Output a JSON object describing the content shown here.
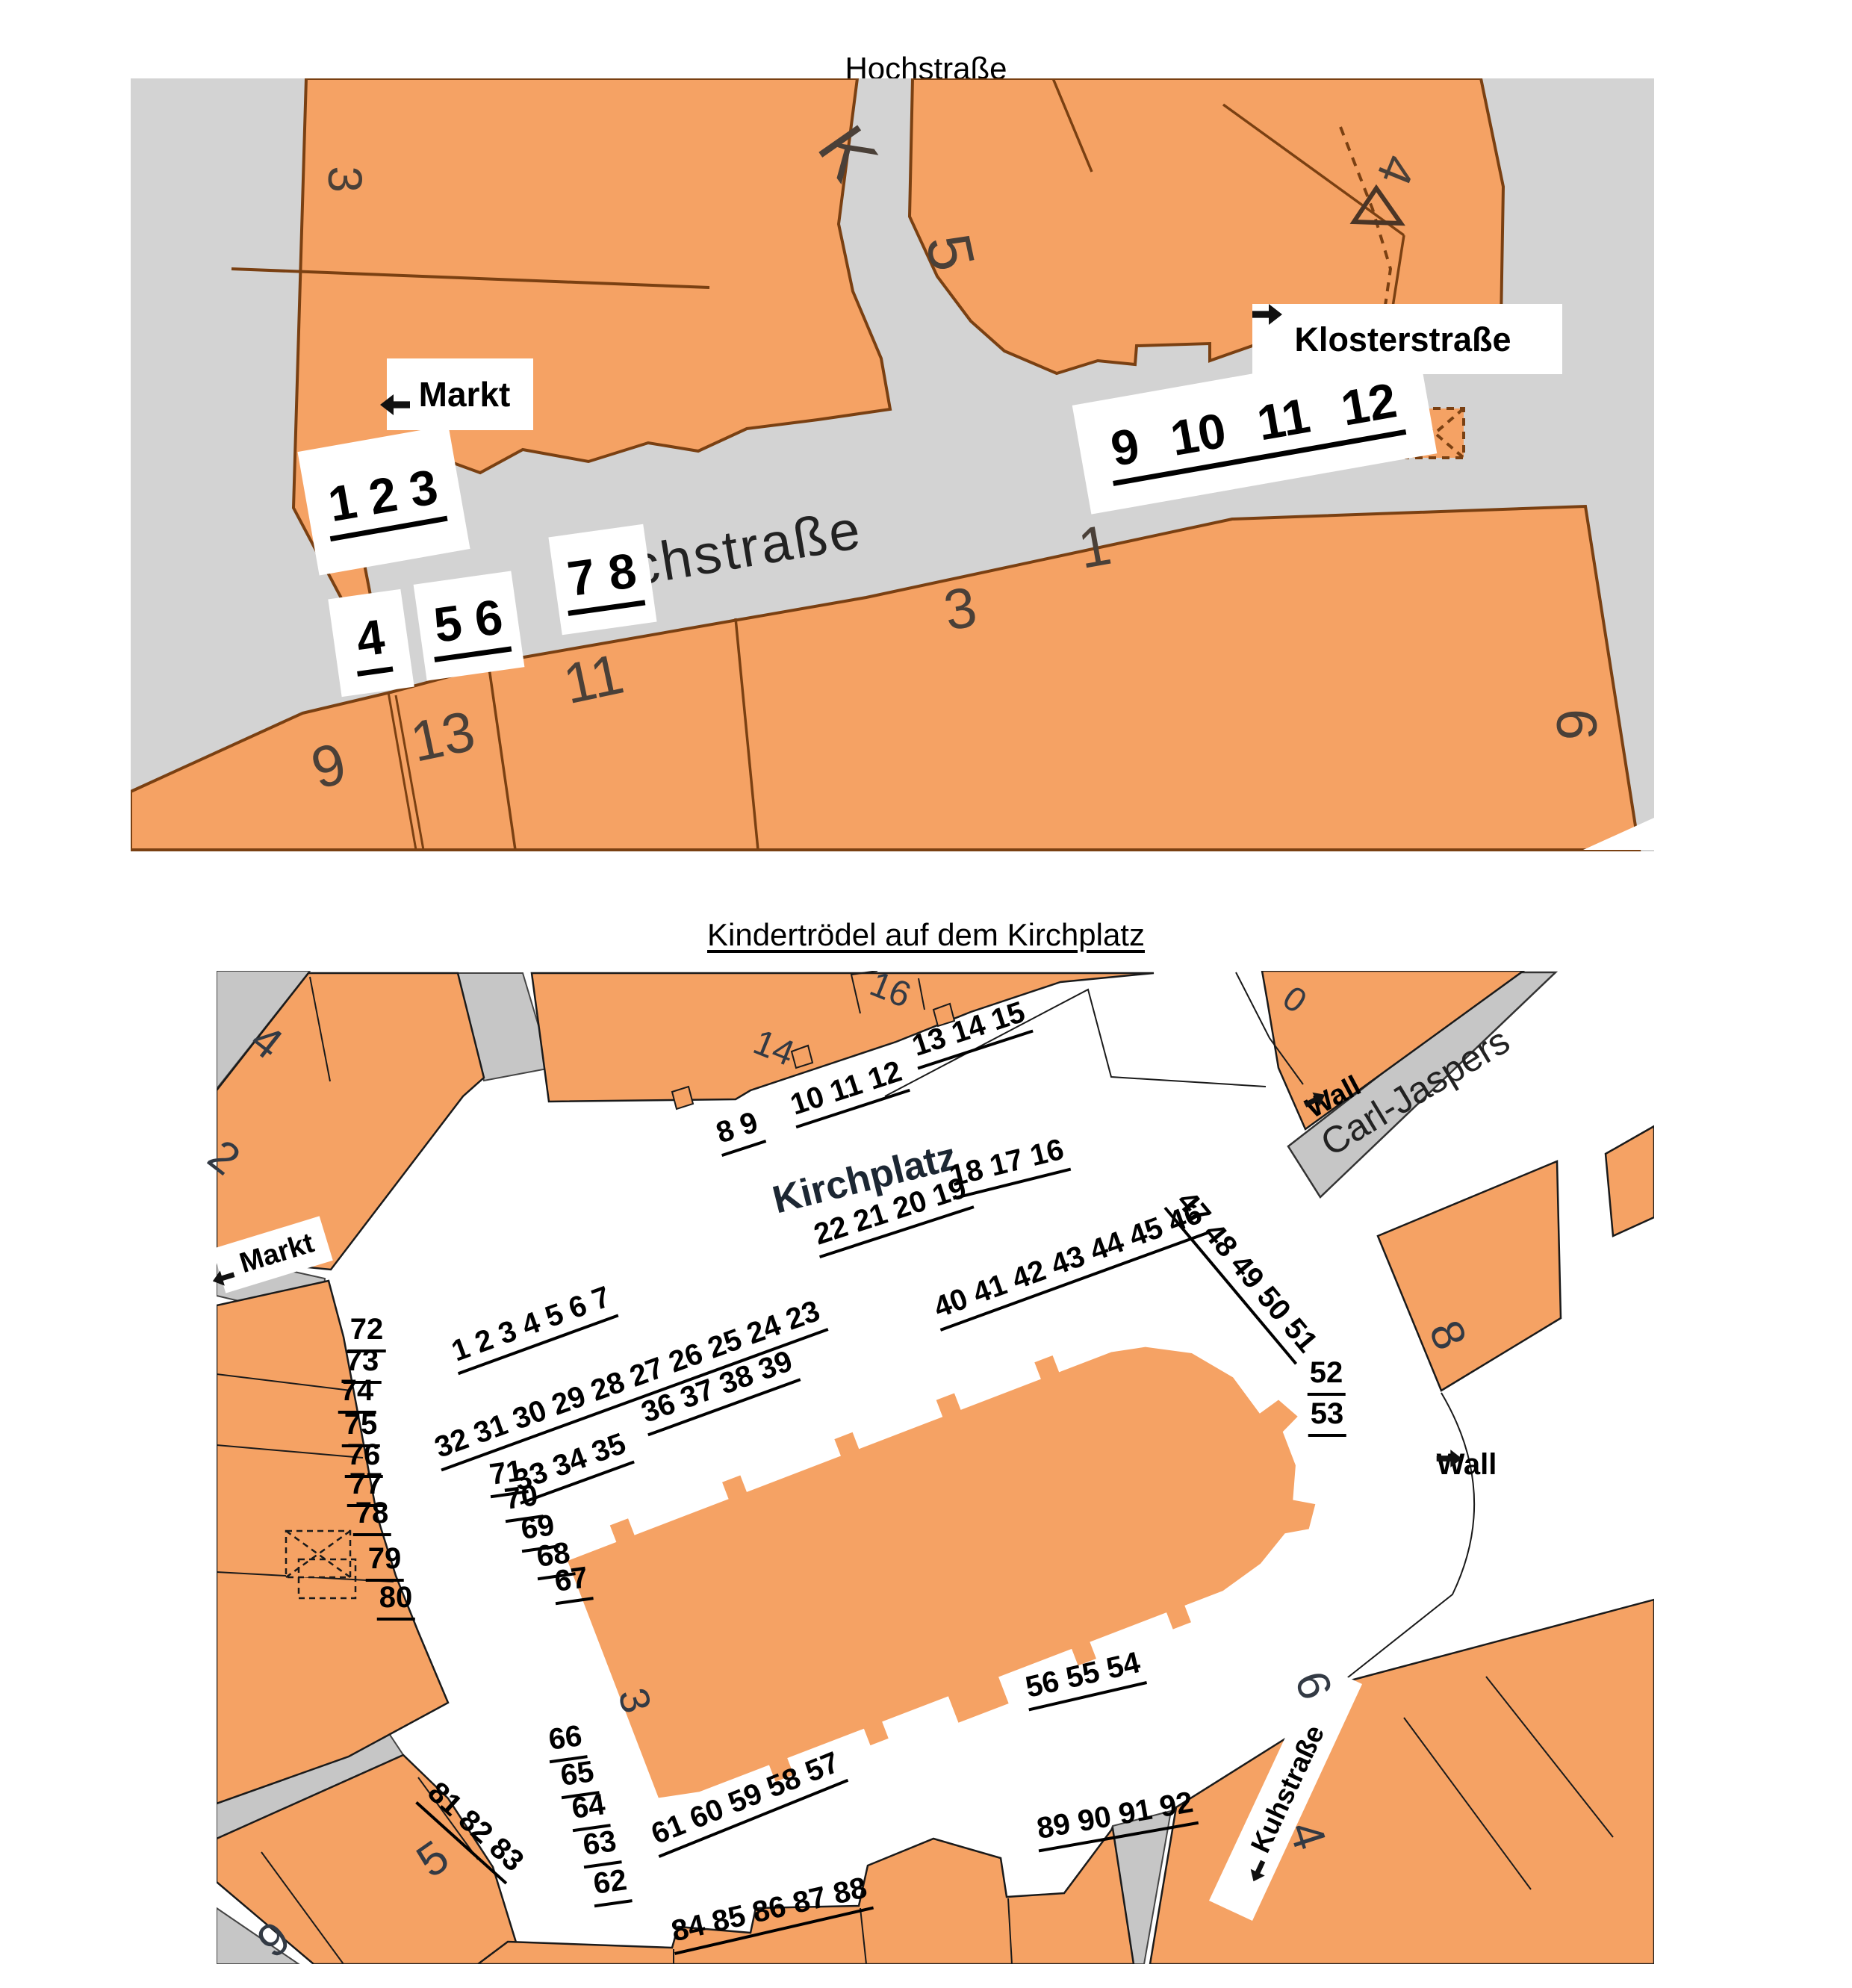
{
  "doc": {
    "title_top": "Hochstraße",
    "title_bottom": "Kindertrödel auf dem Kirchplatz"
  },
  "hochstrasse": {
    "street_label": "Hochstraße",
    "signs": {
      "markt": "Markt",
      "klosterstrasse": "Klosterstraße"
    },
    "stall_groups": {
      "g123": "1 2 3",
      "g4": "4",
      "g56": "5 6",
      "g78": "7 8",
      "g9_12": "9 10 11 12"
    },
    "parcels": {
      "nw3": "3",
      "nw7": "7",
      "k": "K",
      "n5": "5",
      "ne4": "4",
      "s9": "9",
      "s13": "13",
      "s11": "11",
      "s3": "3",
      "s1": "1",
      "e6": "6"
    }
  },
  "kirchplatz": {
    "square_label": "Kirchplatz",
    "streets": {
      "carl_jaspers": "Carl-Jaspers",
      "kuhstrasse": "Kuhstraße"
    },
    "signs": {
      "markt": "Markt",
      "wall_upper": "Wall",
      "wall_right": "Wall"
    },
    "stall_groups": {
      "g8_9": "8 9",
      "g10_12": "10 11 12",
      "g13_15": "13 14 15",
      "g22_19": "22 21 20 19",
      "g18_16": "18 17 16",
      "g1_7": "1 2 3 4 5 6 7",
      "g32_23": "32 31 30 29 28 27 26 25 24 23",
      "g33_35": "33 34 35",
      "g36_39": "36 37 38 39",
      "g40_46": "40 41 42 43 44 45 46",
      "g47_51": "47 48 49 50 51",
      "g52": "52",
      "g53": "53",
      "g61_57": "61 60 59 58 57",
      "g56_54": "56 55 54",
      "g84_88": "84 85 86 87 88",
      "g89_92": "89 90 91 92",
      "g81_83": "81 82 83"
    },
    "west_column": [
      "72",
      "73",
      "74",
      "75",
      "76",
      "77",
      "78",
      "79",
      "80"
    ],
    "church_column_upper": [
      "71",
      "70",
      "69",
      "68",
      "67"
    ],
    "church_column_lower": [
      "66",
      "65",
      "64",
      "63",
      "62"
    ],
    "parcels": {
      "nw4": "4",
      "w2": "2",
      "n14": "14",
      "n16": "16",
      "ne0": "0",
      "e8": "8",
      "church3": "3",
      "se6": "6",
      "se4": "4",
      "sw5": "5",
      "sw9": "9"
    }
  }
}
